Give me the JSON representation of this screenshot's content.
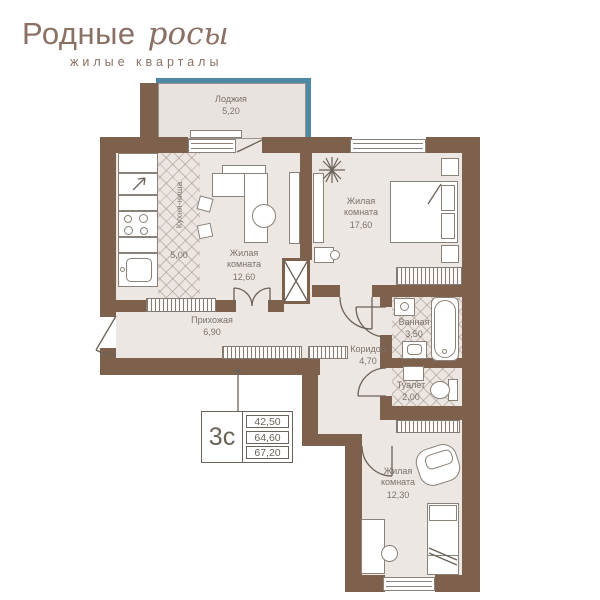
{
  "logo": {
    "brand_primary": "Родные",
    "brand_script": "росы",
    "subtitle": "жилые кварталы"
  },
  "plan": {
    "rooms": [
      {
        "id": "loggia",
        "name": "Лоджия",
        "area": "5,20"
      },
      {
        "id": "kitchen",
        "name": "Кухня-ниша",
        "area": "5,00"
      },
      {
        "id": "living1",
        "name": "Жилая комната",
        "area": "12,60"
      },
      {
        "id": "living2",
        "name": "Жилая комната",
        "area": "17,60"
      },
      {
        "id": "hall",
        "name": "Прихожая",
        "area": "6,90"
      },
      {
        "id": "corridor",
        "name": "Коридор",
        "area": "4,70"
      },
      {
        "id": "bath",
        "name": "Ванная",
        "area": "3,50"
      },
      {
        "id": "wc",
        "name": "Туалет",
        "area": "2,00"
      },
      {
        "id": "living3",
        "name": "Жилая комната",
        "area": "12,30"
      }
    ],
    "callout": {
      "type_label": "3с",
      "areas": [
        "42,50",
        "64,60",
        "67,20"
      ]
    }
  },
  "colors": {
    "wall": "#7D614D",
    "floor": "#EDE7E3",
    "glazing_teal": "#4E89A4",
    "logo_brown": "#8A7164",
    "line_gray": "#6B6258"
  }
}
